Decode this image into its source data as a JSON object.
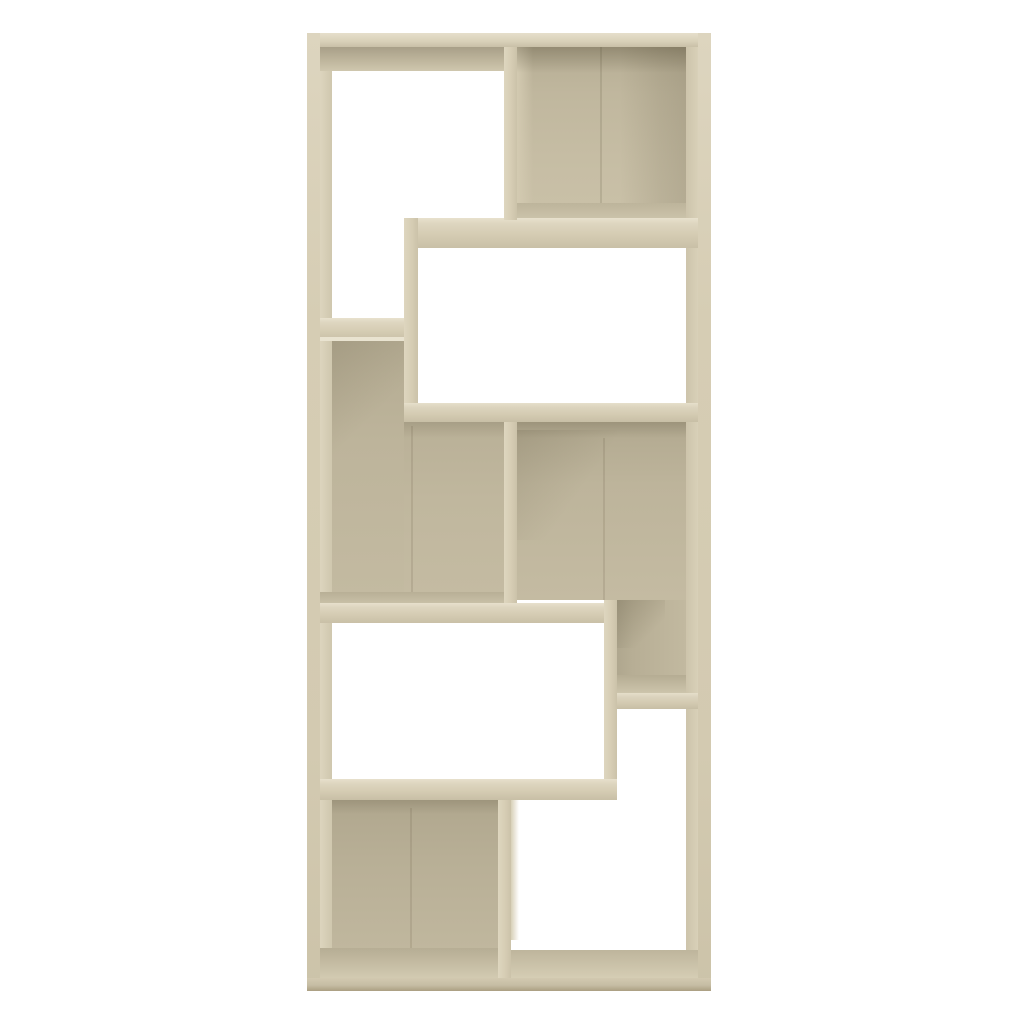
{
  "product": {
    "subject": "geometric cube bookshelf (room divider) product photo",
    "finish_name": "sonoma oak",
    "compartments_total": 8,
    "background_color": "#ffffff"
  },
  "palette": {
    "front_highlight": "#e8e1cd",
    "front_light": "#d6cdb4",
    "front_mid": "#ccc3aa",
    "back_mid": "#c3baa1",
    "back_dark": "#a89f87",
    "floor_light": "#d2cab1",
    "seam": "rgba(90,80,55,0.16)",
    "shadow_tint": "rgba(60,52,30,0.16)"
  },
  "scene": {
    "canvas": {
      "w": 1024,
      "h": 1024
    },
    "parts": [
      {
        "name": "left-panel-inner-face",
        "x": 320,
        "y": 47,
        "w": 12,
        "h": 931,
        "bg": "linear-gradient(90deg,#ddd5be,#cfc7ae)"
      },
      {
        "name": "right-panel-inner-face",
        "x": 686,
        "y": 47,
        "w": 12,
        "h": 931,
        "bg": "linear-gradient(90deg,#cdc4ab,#d8d0b8)"
      },
      {
        "name": "top-underside-shade-left",
        "x": 320,
        "y": 47,
        "w": 184,
        "h": 24,
        "bg": "linear-gradient(180deg,#a89f88 0%,#beb59c 55%,#cfc7ae 100%)"
      },
      {
        "name": "compartment-topright-back-panel",
        "x": 517,
        "y": 47,
        "w": 169,
        "h": 158,
        "bg": "linear-gradient(180deg,#b6ad94 0%,#c0b79e 30%,#c6bda4 70%,#c9c0a7 100%)"
      },
      {
        "name": "compartment-topright-left-side-face",
        "x": 517,
        "y": 47,
        "w": 16,
        "h": 158,
        "bg": "linear-gradient(90deg,#d3cab1,rgba(0,0,0,0))"
      },
      {
        "name": "compartment-topright-right-shade",
        "x": 620,
        "y": 47,
        "w": 66,
        "h": 158,
        "bg": "linear-gradient(90deg,rgba(0,0,0,0) 0%,rgba(60,52,30,0.10) 60%,rgba(60,52,30,0.15) 100%)"
      },
      {
        "name": "compartment-topright-board-seam",
        "x": 600,
        "y": 47,
        "w": 2,
        "h": 158,
        "bg": "rgba(90,80,55,0.16)"
      },
      {
        "name": "compartment-topright-ceiling-shade",
        "x": 517,
        "y": 47,
        "w": 169,
        "h": 26,
        "bg": "linear-gradient(180deg,rgba(60,52,30,0.28),rgba(0,0,0,0))"
      },
      {
        "name": "compartment-topright-floor",
        "x": 517,
        "y": 203,
        "w": 169,
        "h": 20,
        "bg": "linear-gradient(180deg,#bdb49b,#cfc7ae)"
      },
      {
        "name": "shelf-right-upper",
        "x": 404,
        "y": 218,
        "w": 294,
        "h": 30,
        "bg": "linear-gradient(180deg,#e8e1cd 0%,#ded6c0 18%,#d5ccb3 55%,#c9c0a7 100%)"
      },
      {
        "name": "divider-top",
        "x": 504,
        "y": 47,
        "w": 13,
        "h": 173,
        "bg": "linear-gradient(90deg,#ded6bf 0%,#d6cdb4 55%,#cbc2a9 100%)"
      },
      {
        "name": "step-divider-upper",
        "x": 404,
        "y": 218,
        "w": 14,
        "h": 204,
        "bg": "linear-gradient(90deg,#ded6bf 0%,#d6cdb4 55%,#cbc2a9 100%)"
      },
      {
        "name": "shelf-left-upper",
        "x": 312,
        "y": 318,
        "w": 92,
        "h": 22,
        "bg": "linear-gradient(180deg,#e8e1cd 0%,#ded6c0 20%,#d5ccb3 60%,#c9c0a7 100%)"
      },
      {
        "name": "compartment-midleft-back-panel-upper",
        "x": 332,
        "y": 340,
        "w": 72,
        "h": 256,
        "bg": "linear-gradient(180deg,#b4ab92 0%,#bdb49b 40%,#c3baa1 100%)"
      },
      {
        "name": "compartment-midleft-back-panel-lower",
        "x": 404,
        "y": 422,
        "w": 100,
        "h": 174,
        "bg": "linear-gradient(180deg,#b9b097 0%,#c0b79e 45%,#c4bba2 100%)"
      },
      {
        "name": "shelf-left-upper-highlight-edge",
        "x": 320,
        "y": 337,
        "w": 84,
        "h": 4,
        "bg": "#e9e3d0"
      },
      {
        "name": "compartment-midleft-corner-shade",
        "x": 332,
        "y": 341,
        "w": 72,
        "h": 140,
        "bg": "linear-gradient(135deg,rgba(60,52,30,0.12),rgba(0,0,0,0) 55%)"
      },
      {
        "name": "compartment-midleft-under-shelf-shade",
        "x": 404,
        "y": 422,
        "w": 100,
        "h": 16,
        "bg": "linear-gradient(180deg,rgba(60,52,30,0.14),rgba(0,0,0,0))"
      },
      {
        "name": "compartment-midleft-board-seam",
        "x": 411,
        "y": 426,
        "w": 2,
        "h": 170,
        "bg": "rgba(90,80,55,0.14)"
      },
      {
        "name": "compartment-midleft-floor",
        "x": 318,
        "y": 592,
        "w": 186,
        "h": 14,
        "bg": "linear-gradient(180deg,#b8af96,#ccc4ab)"
      },
      {
        "name": "shelf-right-middle",
        "x": 404,
        "y": 403,
        "w": 294,
        "h": 19,
        "bg": "linear-gradient(180deg,#e6dfcb 0%,#dcd4be 22%,#d4cbb2 60%,#c8bfa6 100%)"
      },
      {
        "name": "divider-middle",
        "x": 504,
        "y": 422,
        "w": 13,
        "h": 184,
        "bg": "linear-gradient(90deg,#ded6bf 0%,#d6cdb4 55%,#cbc2a9 100%)"
      },
      {
        "name": "divider-middle-right-side-face",
        "x": 517,
        "y": 422,
        "w": 8,
        "h": 178,
        "bg": "linear-gradient(90deg,#d6ceb5,rgba(0,0,0,0))"
      },
      {
        "name": "compartment-midright-back-panel-upper",
        "x": 517,
        "y": 422,
        "w": 169,
        "h": 178,
        "bg": "linear-gradient(180deg,#b2a990 0%,#bdb49b 35%,#c4bba2 100%)"
      },
      {
        "name": "compartment-midright-under-shelf-shade",
        "x": 517,
        "y": 422,
        "w": 169,
        "h": 16,
        "bg": "linear-gradient(180deg,rgba(60,52,30,0.18),rgba(0,0,0,0))"
      },
      {
        "name": "compartment-midright-corner-shade",
        "x": 517,
        "y": 430,
        "w": 100,
        "h": 110,
        "bg": "linear-gradient(125deg,rgba(60,52,30,0.13),rgba(0,0,0,0) 60%)"
      },
      {
        "name": "compartment-midright-board-seam",
        "x": 603,
        "y": 438,
        "w": 2,
        "h": 162,
        "bg": "rgba(90,80,55,0.14)"
      },
      {
        "name": "compartment-midright-back-panel-lower",
        "x": 604,
        "y": 600,
        "w": 82,
        "h": 77,
        "bg": "linear-gradient(90deg,#a9a189 0%,#b7ae95 35%,#c2b9a0 100%)"
      },
      {
        "name": "compartment-midright-lower-corner-shade",
        "x": 617,
        "y": 600,
        "w": 48,
        "h": 48,
        "bg": "linear-gradient(135deg,rgba(60,52,30,0.20),rgba(0,0,0,0) 70%)"
      },
      {
        "name": "compartment-midright-floor",
        "x": 617,
        "y": 675,
        "w": 69,
        "h": 20,
        "bg": "linear-gradient(180deg,#b5ac93,#cfc7ae)"
      },
      {
        "name": "shelf-left-middle",
        "x": 312,
        "y": 603,
        "w": 292,
        "h": 20,
        "bg": "linear-gradient(180deg,#e7e0cc 0%,#ded6c0 20%,#d5ccb3 58%,#c9c0a7 100%)"
      },
      {
        "name": "step-divider-lower",
        "x": 604,
        "y": 600,
        "w": 13,
        "h": 180,
        "bg": "linear-gradient(90deg,#ded6bf 0%,#d6cdb4 55%,#cbc2a9 100%)"
      },
      {
        "name": "shelf-right-lower",
        "x": 617,
        "y": 693,
        "w": 81,
        "h": 16,
        "bg": "linear-gradient(180deg,#e5deca 0%,#dbd3bd 25%,#d3cab1 62%,#c7bea5 100%)"
      },
      {
        "name": "shelf-left-lower",
        "x": 312,
        "y": 779,
        "w": 305,
        "h": 21,
        "bg": "linear-gradient(180deg,#e7e0cc 0%,#ded6c0 20%,#d5ccb3 58%,#c8bfa6 100%)"
      },
      {
        "name": "compartment-bottomleft-back-panel",
        "x": 332,
        "y": 800,
        "w": 166,
        "h": 150,
        "bg": "linear-gradient(180deg,#b0a78e 0%,#b8af96 40%,#c0b79e 100%)"
      },
      {
        "name": "compartment-bottomleft-under-shelf-shade",
        "x": 332,
        "y": 800,
        "w": 166,
        "h": 14,
        "bg": "linear-gradient(180deg,rgba(60,52,30,0.16),rgba(0,0,0,0))"
      },
      {
        "name": "compartment-bottomleft-board-seam",
        "x": 410,
        "y": 808,
        "w": 2,
        "h": 142,
        "bg": "rgba(90,80,55,0.14)"
      },
      {
        "name": "compartment-bottomleft-floor",
        "x": 318,
        "y": 948,
        "w": 186,
        "h": 30,
        "bg": "linear-gradient(180deg,#b6ad94,#d2cab1)"
      },
      {
        "name": "compartment-bottomright-floor",
        "x": 504,
        "y": 950,
        "w": 194,
        "h": 28,
        "bg": "linear-gradient(180deg,#beb59c,#d5cdb4)"
      },
      {
        "name": "divider-bottom",
        "x": 498,
        "y": 800,
        "w": 13,
        "h": 178,
        "bg": "linear-gradient(90deg,#ded6bf 0%,#d6cdb4 55%,#cbc2a9 100%)"
      },
      {
        "name": "divider-bottom-right-side-face",
        "x": 511,
        "y": 800,
        "w": 8,
        "h": 140,
        "bg": "linear-gradient(90deg,#d8d0b8,rgba(0,0,0,0))"
      },
      {
        "name": "top-panel",
        "x": 307,
        "y": 33,
        "w": 404,
        "h": 14,
        "bg": "linear-gradient(180deg,#e6dfcb 0%,#d8d0b8 60%,#c9c0a7 100%)"
      },
      {
        "name": "left-side-panel",
        "x": 307,
        "y": 33,
        "w": 13,
        "h": 958,
        "bg": "linear-gradient(180deg,#ddd5bf 0%,#d6cdb4 30%,#d3cab1 75%,#ccc3a9 100%)"
      },
      {
        "name": "right-side-panel",
        "x": 698,
        "y": 33,
        "w": 13,
        "h": 958,
        "bg": "linear-gradient(180deg,#ddd5bf 0%,#d6cdb4 30%,#d3cab1 75%,#ccc3a9 100%)"
      },
      {
        "name": "bottom-panel-front-edge",
        "x": 307,
        "y": 978,
        "w": 404,
        "h": 13,
        "bg": "linear-gradient(180deg,#d2c9b0 0%,#c6bda4 55%,#ab9f82 100%)"
      }
    ]
  }
}
